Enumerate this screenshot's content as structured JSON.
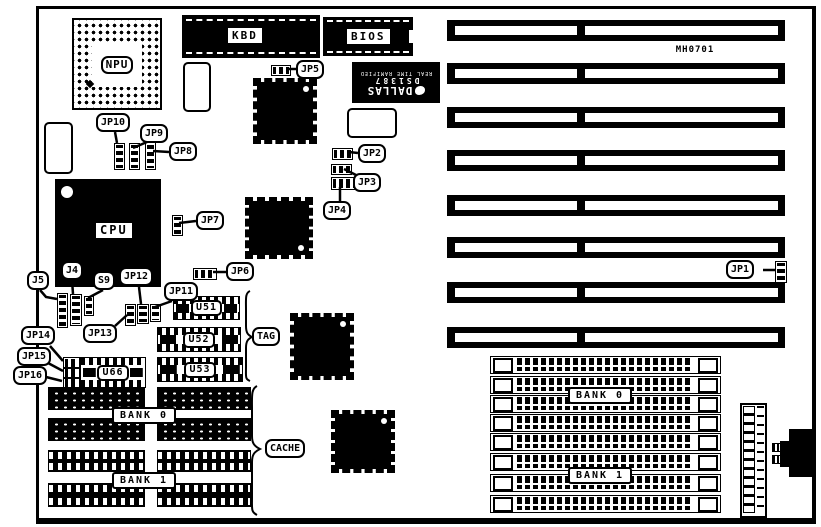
{
  "colors": {
    "ink": "#000000",
    "paper": "#ffffff"
  },
  "board": {
    "part_number": "MH0701"
  },
  "chips": {
    "npu": "NPU",
    "kbd": "KBD",
    "bios": "BIOS",
    "cpu": "CPU",
    "u51": "U51",
    "u52": "U52",
    "u53": "U53",
    "u66": "U66"
  },
  "dallas": {
    "brand": "DALLAS",
    "part": "DS1387",
    "subtitle": "REAL TIME RAMIFIED"
  },
  "jumpers": {
    "jp1": "JP1",
    "jp2": "JP2",
    "jp3": "JP3",
    "jp4": "JP4",
    "jp5": "JP5",
    "jp6": "JP6",
    "jp7": "JP7",
    "jp8": "JP8",
    "jp9": "JP9",
    "jp10": "JP10",
    "jp11": "JP11",
    "jp12": "JP12",
    "jp13": "JP13",
    "jp14": "JP14",
    "jp15": "JP15",
    "jp16": "JP16",
    "j4": "J4",
    "j5": "J5",
    "s9": "S9"
  },
  "memory": {
    "tag": "TAG",
    "cache": "CACHE",
    "cache_bank0": "BANK 0",
    "cache_bank1": "BANK 1",
    "simm_bank0": "BANK 0",
    "simm_bank1": "BANK 1"
  }
}
